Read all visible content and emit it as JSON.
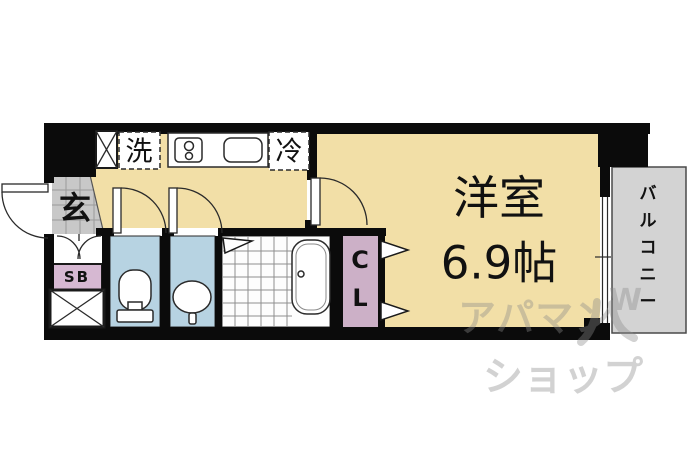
{
  "plan": {
    "rooms": {
      "main_room": {
        "name": "洋室",
        "size": "6.9帖"
      },
      "balcony": {
        "label": "バルコニー",
        "chars": [
          "バ",
          "ル",
          "コ",
          "ニ",
          "ー"
        ]
      },
      "entrance": {
        "label": "玄"
      },
      "closet": {
        "label": "CL",
        "char1": "C",
        "char2": "L"
      },
      "shoe_box": {
        "label": "SB"
      }
    },
    "labels": {
      "washer": "洗",
      "fridge": "冷"
    },
    "watermark": {
      "line1": "アパマン",
      "line2": "ショップ",
      "logo": "W"
    },
    "colors": {
      "floor": "#f2dfa7",
      "wet_room": "#b7d3e2",
      "closet": "#ccb0c7",
      "shoe_box": "#d6b8d2",
      "entrance_tile": "#c8c8c8",
      "balcony": "#d3d3d3",
      "wall": "#0b0b0b",
      "watermark_grey": "#8a8a8a"
    }
  }
}
